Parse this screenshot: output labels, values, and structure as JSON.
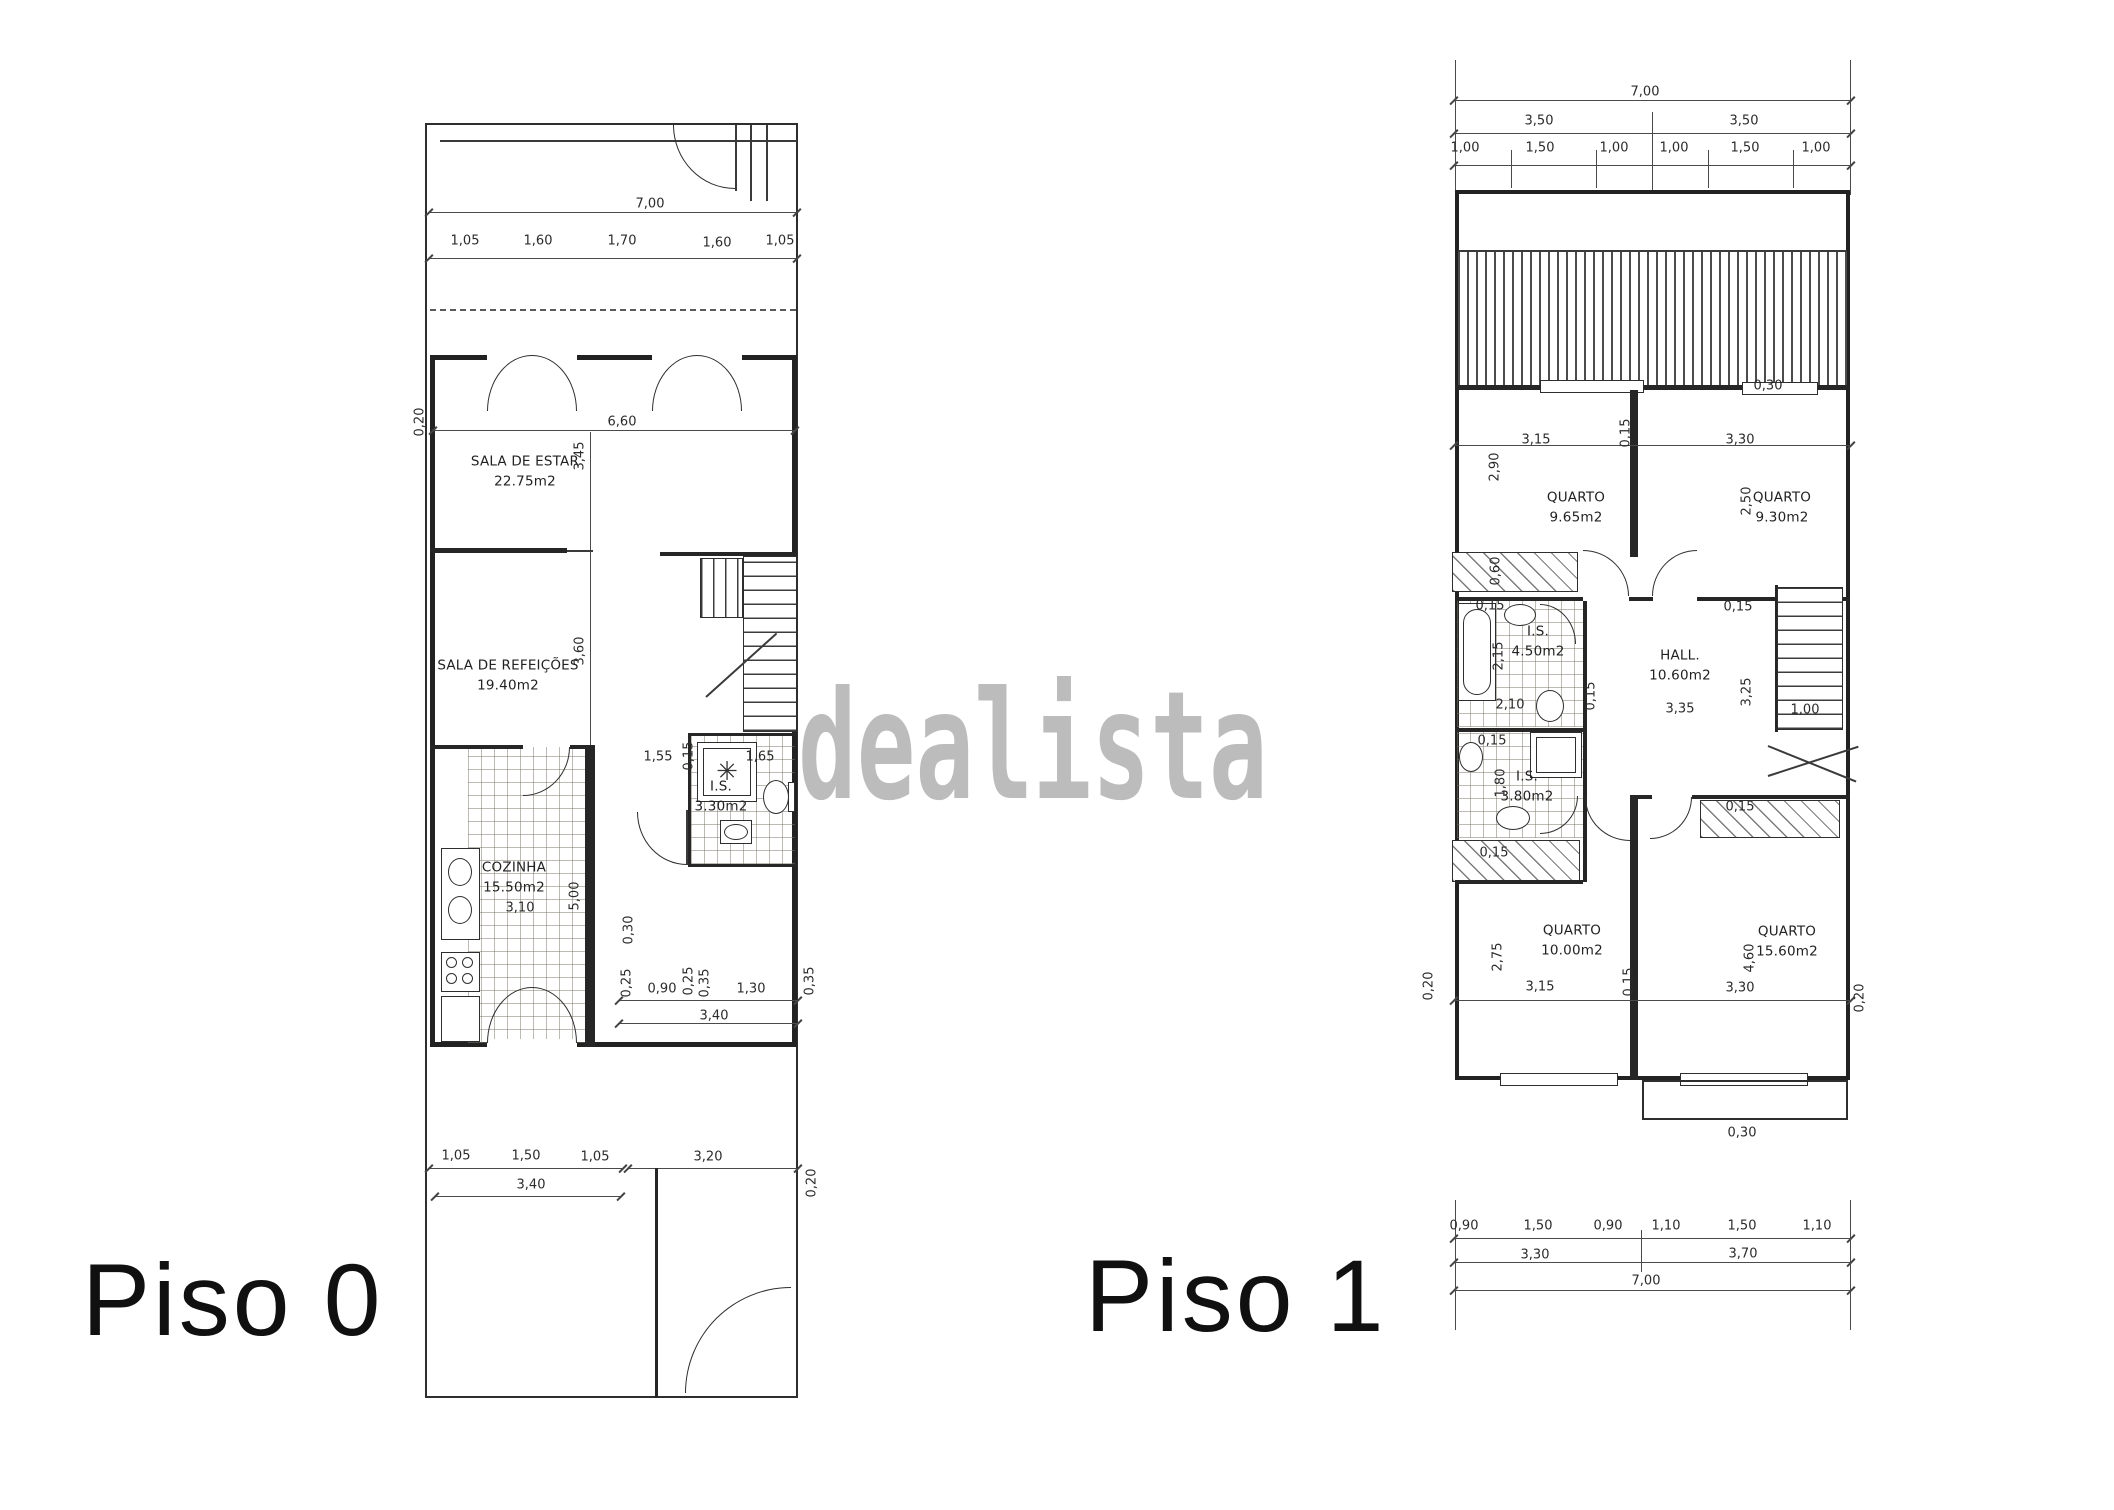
{
  "watermark": {
    "text": "dealista",
    "color": "#b5b5b5"
  },
  "floor0": {
    "label": "Piso 0",
    "rooms": [
      {
        "name": "SALA DE ESTAR",
        "area": "22.75m2",
        "x": 525,
        "y": 472
      },
      {
        "name": "SALA DE REFEIÇÕES",
        "area": "19.40m2",
        "x": 508,
        "y": 676
      },
      {
        "name": "COZINHA",
        "area": "15.50m2",
        "x": 514,
        "y": 878
      },
      {
        "name": "I.S.",
        "area": "3.30m2",
        "x": 721,
        "y": 797
      }
    ]
  },
  "floor1": {
    "label": "Piso 1",
    "rooms": [
      {
        "name": "QUARTO",
        "area": "9.65m2",
        "x": 1576,
        "y": 508
      },
      {
        "name": "QUARTO",
        "area": "9.30m2",
        "x": 1782,
        "y": 508
      },
      {
        "name": "I.S.",
        "area": "4.50m2",
        "x": 1538,
        "y": 642
      },
      {
        "name": "HALL.",
        "area": "10.60m2",
        "x": 1680,
        "y": 666
      },
      {
        "name": "I.S.",
        "area": "3.80m2",
        "x": 1527,
        "y": 787
      },
      {
        "name": "QUARTO",
        "area": "10.00m2",
        "x": 1572,
        "y": 941
      },
      {
        "name": "QUARTO",
        "area": "15.60m2",
        "x": 1787,
        "y": 942
      }
    ]
  },
  "annotations": [
    {
      "t": "7,00",
      "x": 650,
      "y": 204
    },
    {
      "t": "1,05",
      "x": 465,
      "y": 241
    },
    {
      "t": "1,60",
      "x": 538,
      "y": 241
    },
    {
      "t": "1,70",
      "x": 622,
      "y": 241
    },
    {
      "t": "1,60",
      "x": 717,
      "y": 243
    },
    {
      "t": "1,05",
      "x": 780,
      "y": 241
    },
    {
      "t": "6,60",
      "x": 622,
      "y": 422
    },
    {
      "t": "0,20",
      "x": 420,
      "y": 422,
      "r": 1
    },
    {
      "t": "3,45",
      "x": 580,
      "y": 456,
      "r": 1
    },
    {
      "t": "3,60",
      "x": 580,
      "y": 651,
      "r": 1
    },
    {
      "t": "1,55",
      "x": 658,
      "y": 757
    },
    {
      "t": "0,15",
      "x": 689,
      "y": 756,
      "r": 1
    },
    {
      "t": "1,65",
      "x": 760,
      "y": 757
    },
    {
      "t": "5,00",
      "x": 575,
      "y": 896,
      "r": 1
    },
    {
      "t": "3,10",
      "x": 520,
      "y": 908
    },
    {
      "t": "0,30",
      "x": 629,
      "y": 930,
      "r": 1
    },
    {
      "t": "0,25",
      "x": 627,
      "y": 983,
      "r": 1
    },
    {
      "t": "0,90",
      "x": 662,
      "y": 989
    },
    {
      "t": "0,25",
      "x": 689,
      "y": 981,
      "r": 1
    },
    {
      "t": "0,35",
      "x": 705,
      "y": 983,
      "r": 1
    },
    {
      "t": "1,30",
      "x": 751,
      "y": 989
    },
    {
      "t": "0,35",
      "x": 810,
      "y": 981,
      "r": 1
    },
    {
      "t": "3,40",
      "x": 714,
      "y": 1016
    },
    {
      "t": "1,05",
      "x": 456,
      "y": 1156
    },
    {
      "t": "1,50",
      "x": 526,
      "y": 1156
    },
    {
      "t": "1,05",
      "x": 595,
      "y": 1157
    },
    {
      "t": "3,20",
      "x": 708,
      "y": 1157
    },
    {
      "t": "3,40",
      "x": 531,
      "y": 1185
    },
    {
      "t": "0,20",
      "x": 812,
      "y": 1183,
      "r": 1
    },
    {
      "t": "✳",
      "x": 727,
      "y": 772,
      "s": 26,
      "c": "glyph"
    },
    {
      "t": "7,00",
      "x": 1645,
      "y": 92
    },
    {
      "t": "3,50",
      "x": 1539,
      "y": 121
    },
    {
      "t": "3,50",
      "x": 1744,
      "y": 121
    },
    {
      "t": "1,00",
      "x": 1465,
      "y": 148
    },
    {
      "t": "1,50",
      "x": 1540,
      "y": 148
    },
    {
      "t": "1,00",
      "x": 1614,
      "y": 148
    },
    {
      "t": "1,00",
      "x": 1674,
      "y": 148
    },
    {
      "t": "1,50",
      "x": 1745,
      "y": 148
    },
    {
      "t": "1,00",
      "x": 1816,
      "y": 148
    },
    {
      "t": "0,30",
      "x": 1768,
      "y": 386
    },
    {
      "t": "3,15",
      "x": 1536,
      "y": 440
    },
    {
      "t": "0,15",
      "x": 1626,
      "y": 433,
      "r": 1
    },
    {
      "t": "3,30",
      "x": 1740,
      "y": 440
    },
    {
      "t": "2,90",
      "x": 1495,
      "y": 467,
      "r": 1
    },
    {
      "t": "2,50",
      "x": 1747,
      "y": 501,
      "r": 1
    },
    {
      "t": "0,60",
      "x": 1496,
      "y": 571,
      "r": 1
    },
    {
      "t": "0,15",
      "x": 1490,
      "y": 606
    },
    {
      "t": "2,15",
      "x": 1499,
      "y": 656,
      "r": 1
    },
    {
      "t": "2,10",
      "x": 1510,
      "y": 705
    },
    {
      "t": "0,15",
      "x": 1591,
      "y": 696,
      "r": 1
    },
    {
      "t": "0,15",
      "x": 1738,
      "y": 607
    },
    {
      "t": "3,35",
      "x": 1680,
      "y": 709
    },
    {
      "t": "3,25",
      "x": 1747,
      "y": 692,
      "r": 1
    },
    {
      "t": "1,00",
      "x": 1805,
      "y": 710
    },
    {
      "t": "0,15",
      "x": 1492,
      "y": 741
    },
    {
      "t": "1,80",
      "x": 1501,
      "y": 783,
      "r": 1
    },
    {
      "t": "0,15",
      "x": 1494,
      "y": 853
    },
    {
      "t": "0,15",
      "x": 1740,
      "y": 807
    },
    {
      "t": "2,75",
      "x": 1498,
      "y": 957,
      "r": 1
    },
    {
      "t": "3,15",
      "x": 1540,
      "y": 987
    },
    {
      "t": "0,15",
      "x": 1629,
      "y": 982,
      "r": 1
    },
    {
      "t": "3,30",
      "x": 1740,
      "y": 988
    },
    {
      "t": "4,60",
      "x": 1750,
      "y": 958,
      "r": 1
    },
    {
      "t": "0,20",
      "x": 1429,
      "y": 986,
      "r": 1
    },
    {
      "t": "0,20",
      "x": 1860,
      "y": 998,
      "r": 1
    },
    {
      "t": "0,30",
      "x": 1742,
      "y": 1133
    },
    {
      "t": "0,90",
      "x": 1464,
      "y": 1226
    },
    {
      "t": "1,50",
      "x": 1538,
      "y": 1226
    },
    {
      "t": "0,90",
      "x": 1608,
      "y": 1226
    },
    {
      "t": "1,10",
      "x": 1666,
      "y": 1226
    },
    {
      "t": "1,50",
      "x": 1742,
      "y": 1226
    },
    {
      "t": "1,10",
      "x": 1817,
      "y": 1226
    },
    {
      "t": "3,30",
      "x": 1535,
      "y": 1255
    },
    {
      "t": "3,70",
      "x": 1743,
      "y": 1254
    },
    {
      "t": "7,00",
      "x": 1646,
      "y": 1281
    }
  ]
}
